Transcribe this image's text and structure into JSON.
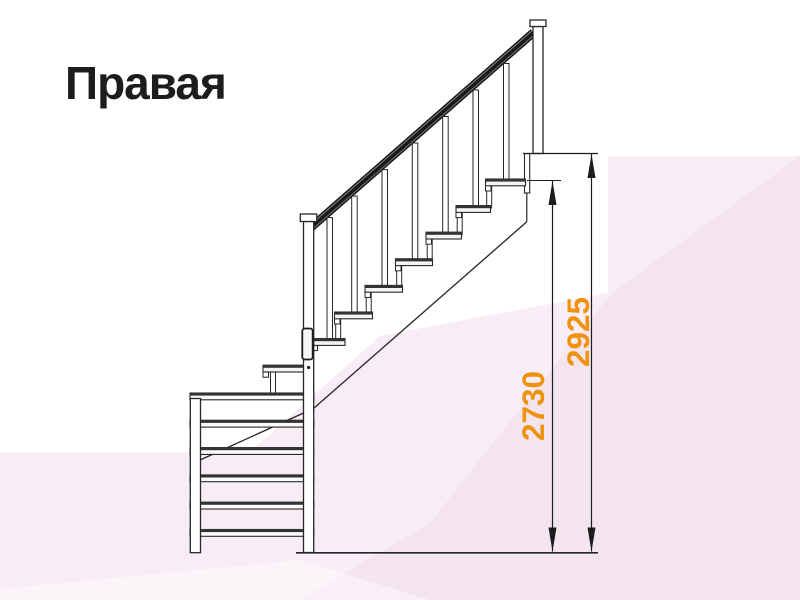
{
  "diagram": {
    "title": "Правая",
    "subject": "staircase-side-view-right-handed",
    "dimension_labels": {
      "inner_height_mm": "2730",
      "total_height_mm": "2925"
    },
    "colors": {
      "dimension_text": "#EE9310",
      "drawing_line": "#262626",
      "handrail_dark": "#1a1a1a",
      "background_white": "#ffffff",
      "background_pink_light": "#f8edf5",
      "background_pink_deep": "#f3e4ee",
      "title_text": "#1c1c1c"
    }
  }
}
